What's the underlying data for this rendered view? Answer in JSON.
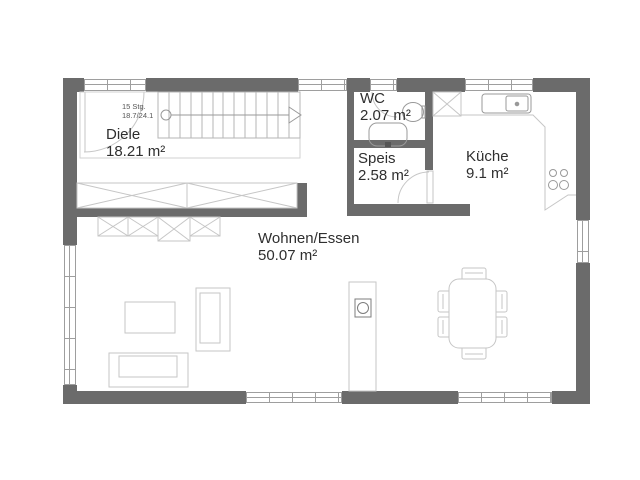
{
  "plan": {
    "title": "Erdgeschoss Grundriss",
    "rooms": [
      {
        "id": "diele",
        "name": "Diele",
        "area": "18.21 m²"
      },
      {
        "id": "wc",
        "name": "WC",
        "area": "2.07 m²"
      },
      {
        "id": "speis",
        "name": "Speis",
        "area": "2.58 m²"
      },
      {
        "id": "kueche",
        "name": "Küche",
        "area": "9.1 m²"
      },
      {
        "id": "wohnen-essen",
        "name": "Wohnen/Essen",
        "area": "50.07 m²"
      }
    ],
    "stairs": {
      "steps_label": "15 Stg.",
      "rise_run_label": "18.7/24.1"
    },
    "colors": {
      "wall": "#6b6b6b",
      "furniture": "#c6c6c6",
      "fixture": "#999999",
      "frame": "#9e9e9e",
      "text": "#2f2f2f",
      "background": "#ffffff"
    }
  }
}
